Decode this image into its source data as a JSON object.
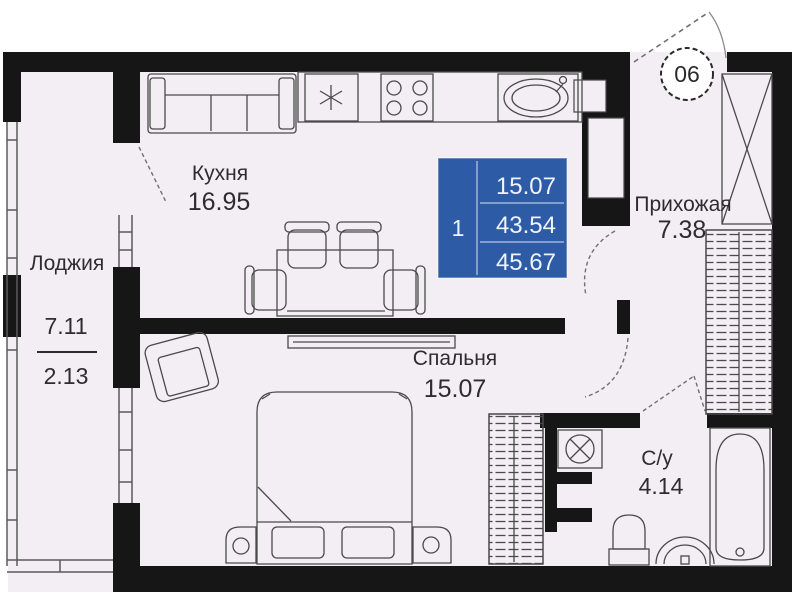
{
  "unit_badge": {
    "number": "06"
  },
  "info_box": {
    "room_count": "1",
    "values": [
      "15.07",
      "43.54",
      "45.67"
    ],
    "color": "#2d5ba6"
  },
  "rooms": {
    "kitchen": {
      "label": "Кухня",
      "area": "16.95"
    },
    "bedroom": {
      "label": "Спальня",
      "area": "15.07"
    },
    "hallway": {
      "label": "Прихожая",
      "area": "7.38"
    },
    "bathroom": {
      "label": "С/у",
      "area": "4.14"
    },
    "loggia": {
      "label": "Лоджия",
      "area_total": "7.11",
      "area_reduced": "2.13"
    }
  },
  "colors": {
    "wall": "#161616",
    "floor": "#f3eef3",
    "accent": "#2d5ba6"
  }
}
